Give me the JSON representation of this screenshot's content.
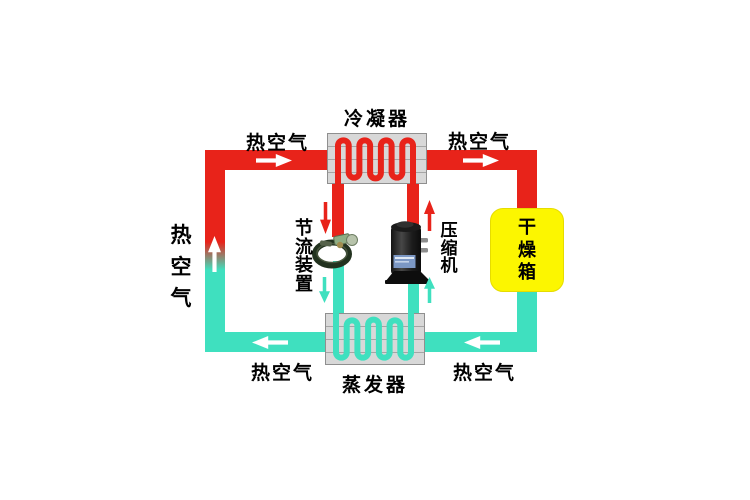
{
  "diagram": {
    "components": {
      "condenser": {
        "label": "冷凝器"
      },
      "evaporator": {
        "label": "蒸发器"
      },
      "throttle_device": {
        "label": "节流装置"
      },
      "compressor": {
        "label": "压缩机"
      },
      "drying_box": {
        "label": "干燥箱"
      }
    },
    "air_labels": {
      "top_left": "热空气",
      "top_right": "热空气",
      "left": "热空气",
      "bottom_left": "热空气",
      "bottom_right": "热空气"
    },
    "colors": {
      "hot_pipe": "#e8231a",
      "cold_pipe": "#3fe0bf",
      "drying_box_fill": "#fcf600",
      "exchanger_fill": "#d8d8d8",
      "exchanger_border": "#8f8f8f",
      "arrow_white": "#ffffff"
    }
  }
}
